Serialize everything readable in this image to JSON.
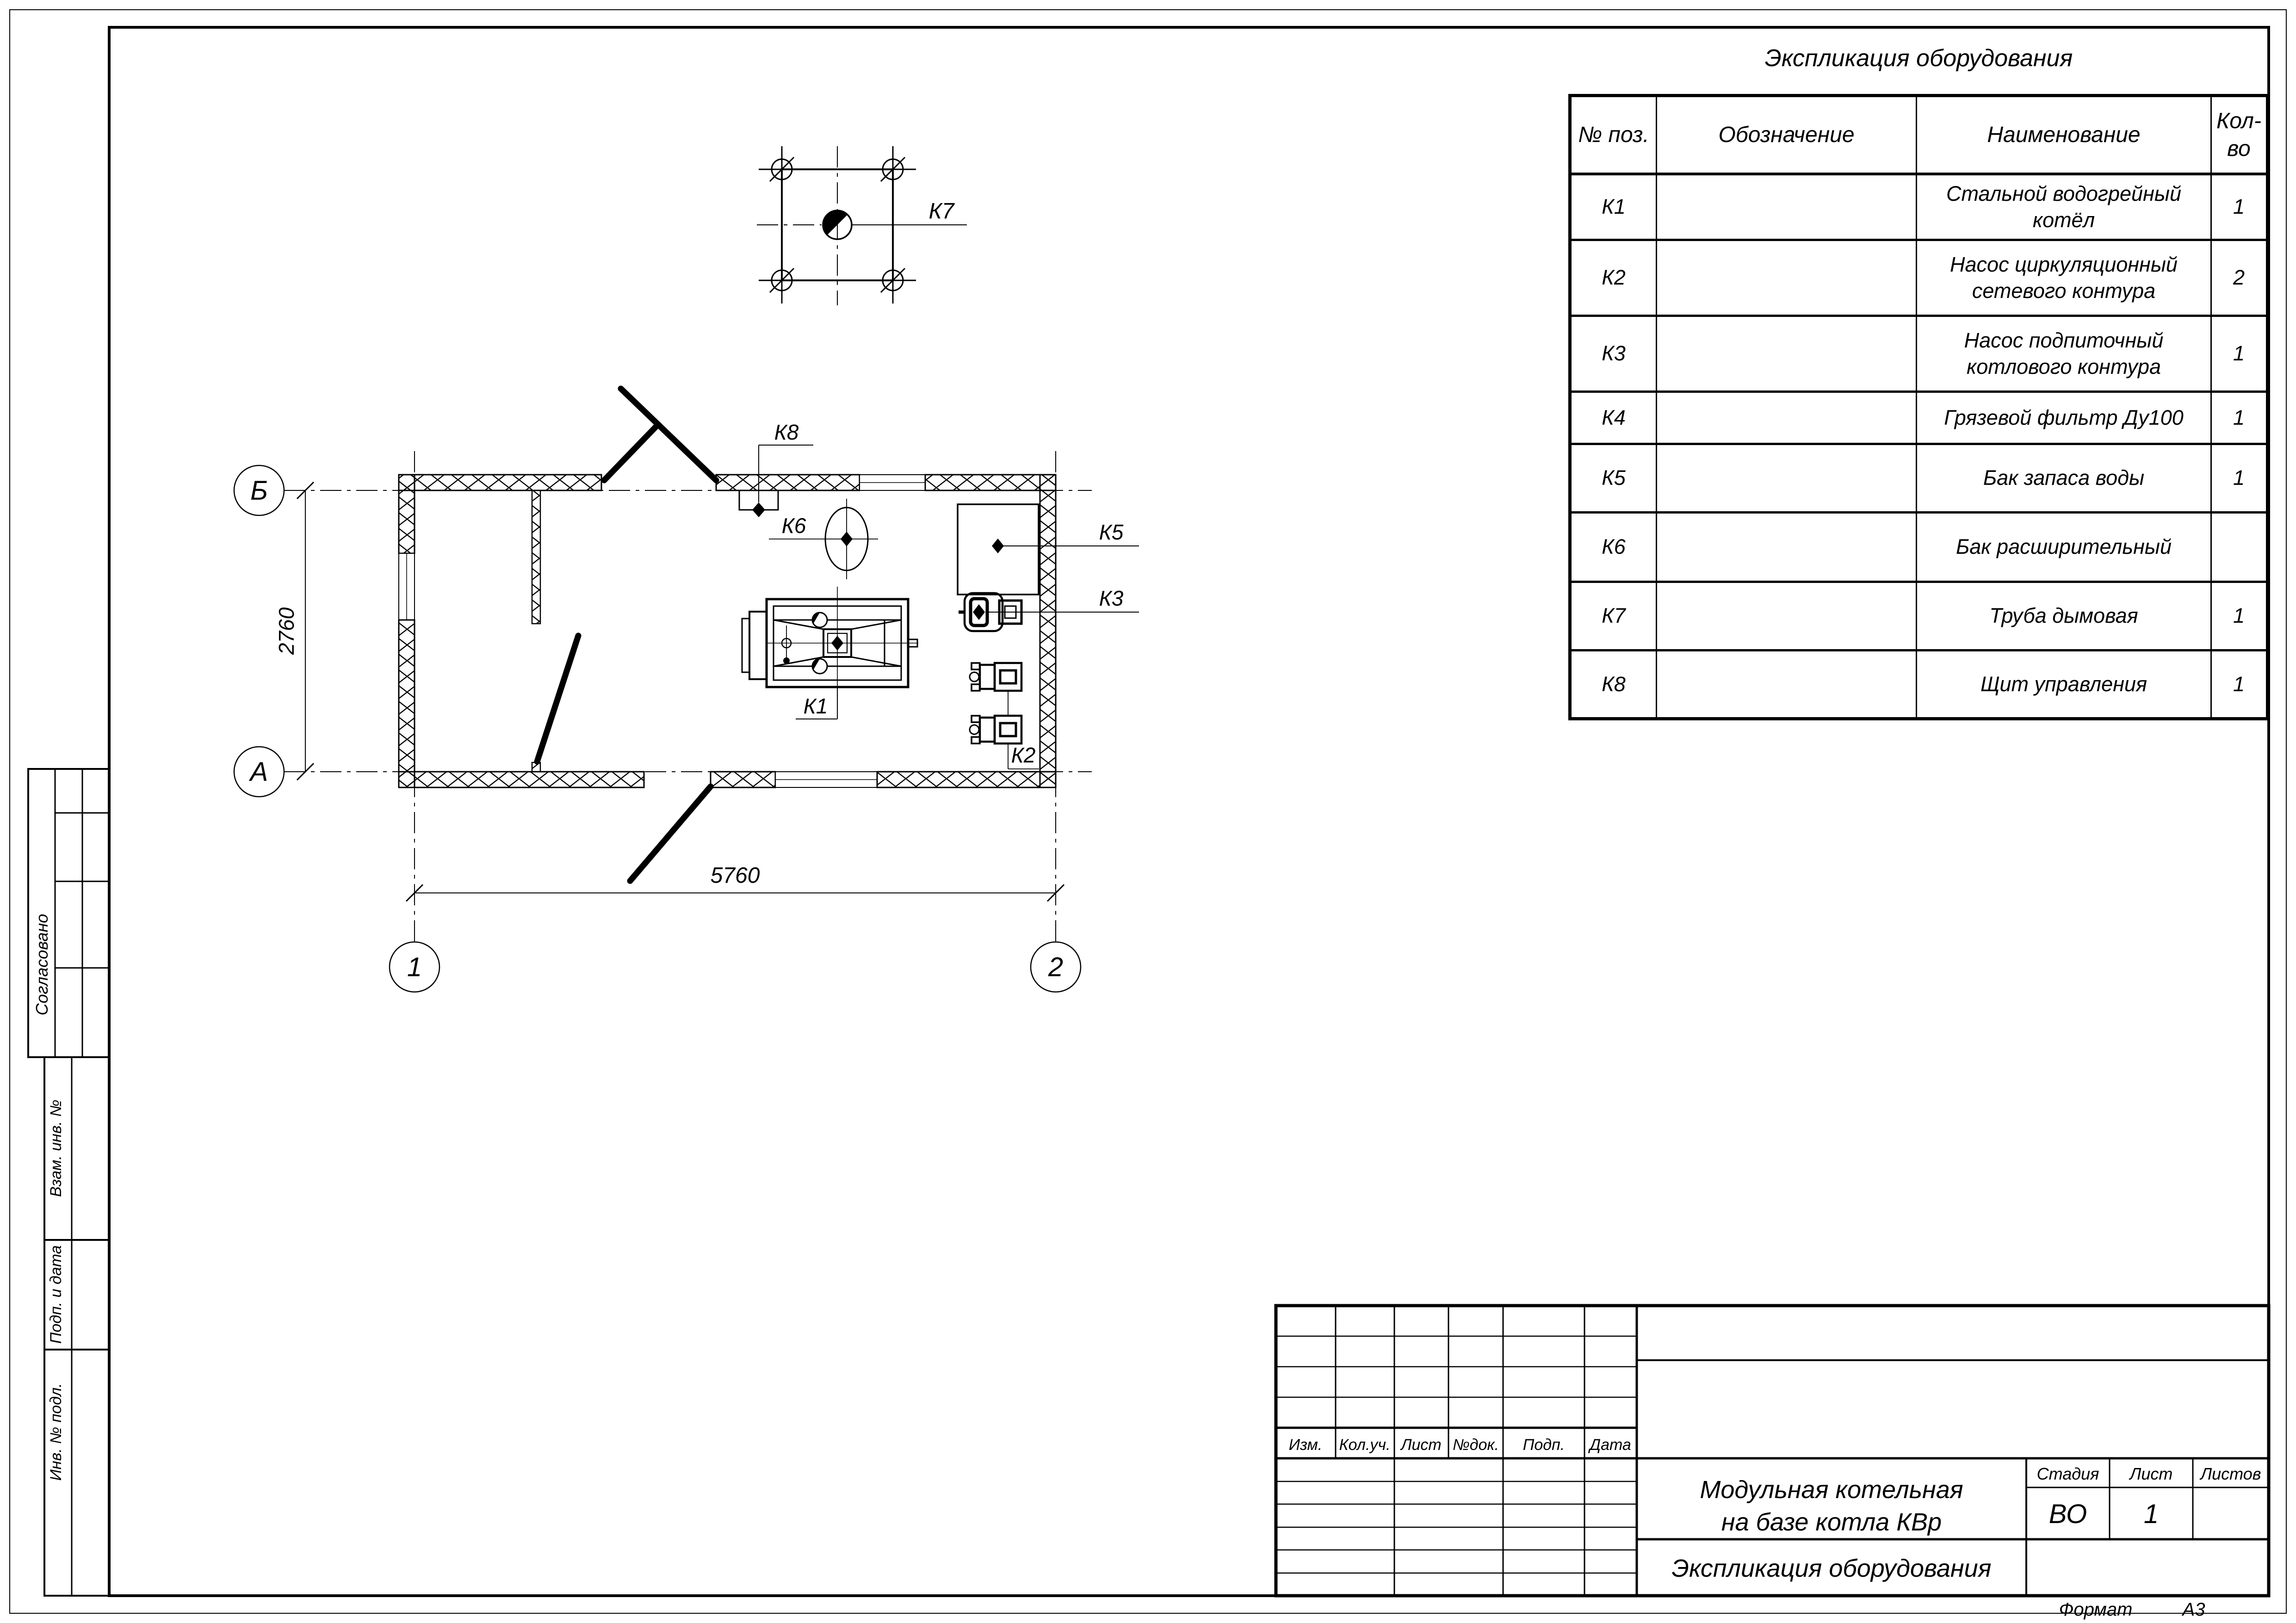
{
  "colors": {
    "line": "#000000",
    "paper": "#ffffff"
  },
  "sheet": {
    "format_label": "Формат",
    "format_value": "А3"
  },
  "equipment_table": {
    "title": "Экспликация оборудования",
    "headers": [
      "№ поз.",
      "Обозначение",
      "Наименование",
      "Кол-во"
    ],
    "rows": [
      {
        "pos": "К1",
        "designation": "",
        "name": "Стальной водогрейный котёл",
        "qty": "1"
      },
      {
        "pos": "К2",
        "designation": "",
        "name": "Насос циркуляционный сетевого контура",
        "qty": "2"
      },
      {
        "pos": "К3",
        "designation": "",
        "name": "Насос подпиточный котлового контура",
        "qty": "1"
      },
      {
        "pos": "К4",
        "designation": "",
        "name": "Грязевой фильтр Ду100",
        "qty": "1"
      },
      {
        "pos": "К5",
        "designation": "",
        "name": "Бак запаса воды",
        "qty": "1"
      },
      {
        "pos": "К6",
        "designation": "",
        "name": "Бак расширительный",
        "qty": ""
      },
      {
        "pos": "К7",
        "designation": "",
        "name": "Труба дымовая",
        "qty": "1"
      },
      {
        "pos": "К8",
        "designation": "",
        "name": "Щит управления",
        "qty": "1"
      }
    ]
  },
  "plan": {
    "axes": {
      "top_letter": "Б",
      "bottom_letter": "А",
      "left_number": "1",
      "right_number": "2"
    },
    "dimensions": {
      "width": "5760",
      "height": "2760"
    },
    "equipment_labels": {
      "k1": "К1",
      "k2": "К2",
      "k3": "К3",
      "k5": "К5",
      "k6": "К6",
      "k7": "К7",
      "k8": "К8"
    }
  },
  "title_block": {
    "revision_headers": [
      "Изм.",
      "Кол.уч.",
      "Лист",
      "№док.",
      "Подп.",
      "Дата"
    ],
    "project_title_line1": "Модульная котельная",
    "project_title_line2": "на базе котла КВр",
    "doc_title": "Экспликация оборудования",
    "stage_label": "Стадия",
    "sheet_label": "Лист",
    "sheets_label": "Листов",
    "stage_value": "ВО",
    "sheet_value": "1",
    "sheets_value": ""
  },
  "sidebar": {
    "items": [
      "Согласовано",
      "Взам. инв. №",
      "Подп. и дата",
      "Инв. № подл."
    ]
  }
}
